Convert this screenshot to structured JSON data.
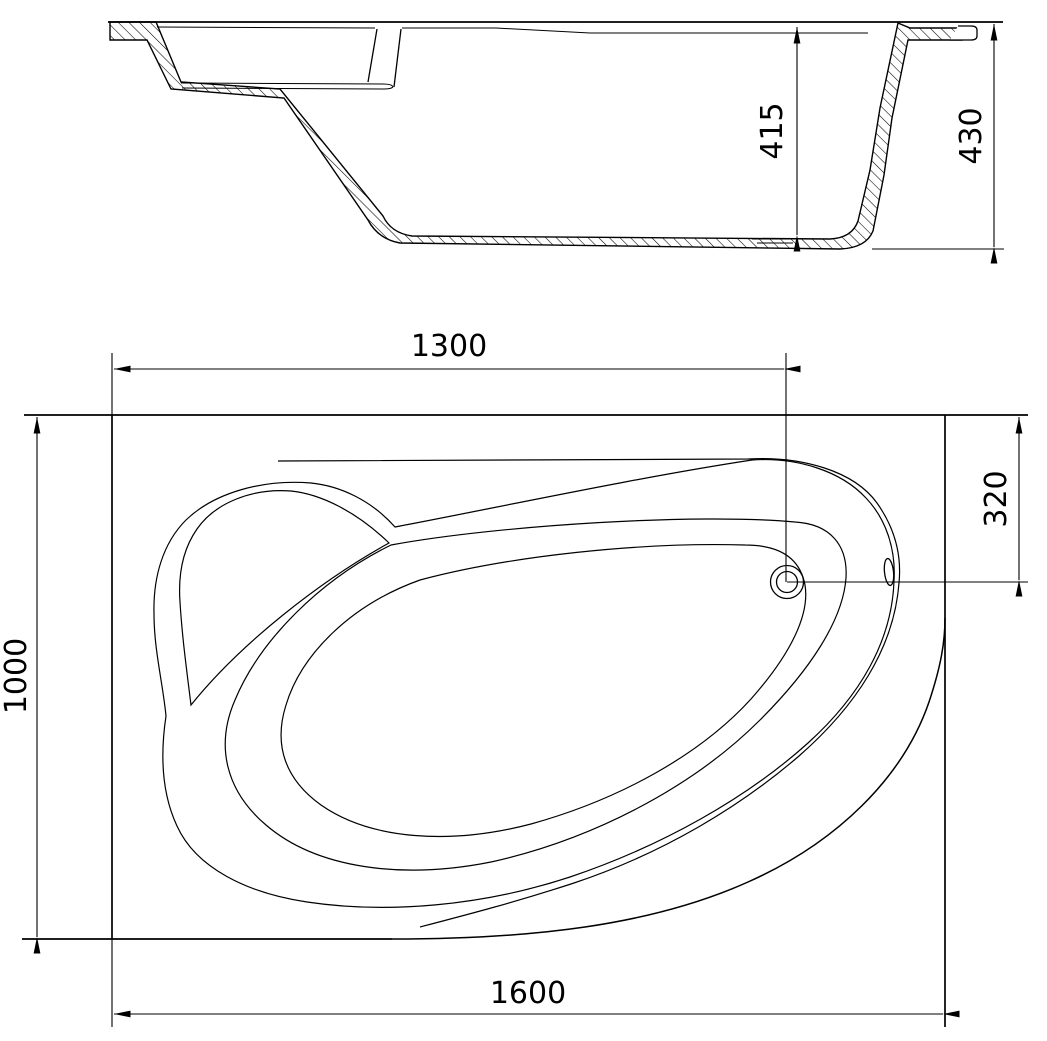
{
  "drawing": {
    "dims": {
      "inner_depth": "415",
      "overall_height": "430",
      "length_to_drain": "1300",
      "width_to_drain": "320",
      "overall_width": "1000",
      "overall_length": "1600"
    },
    "colors": {
      "line": "#000000",
      "text": "#000000",
      "background": "#ffffff"
    }
  }
}
